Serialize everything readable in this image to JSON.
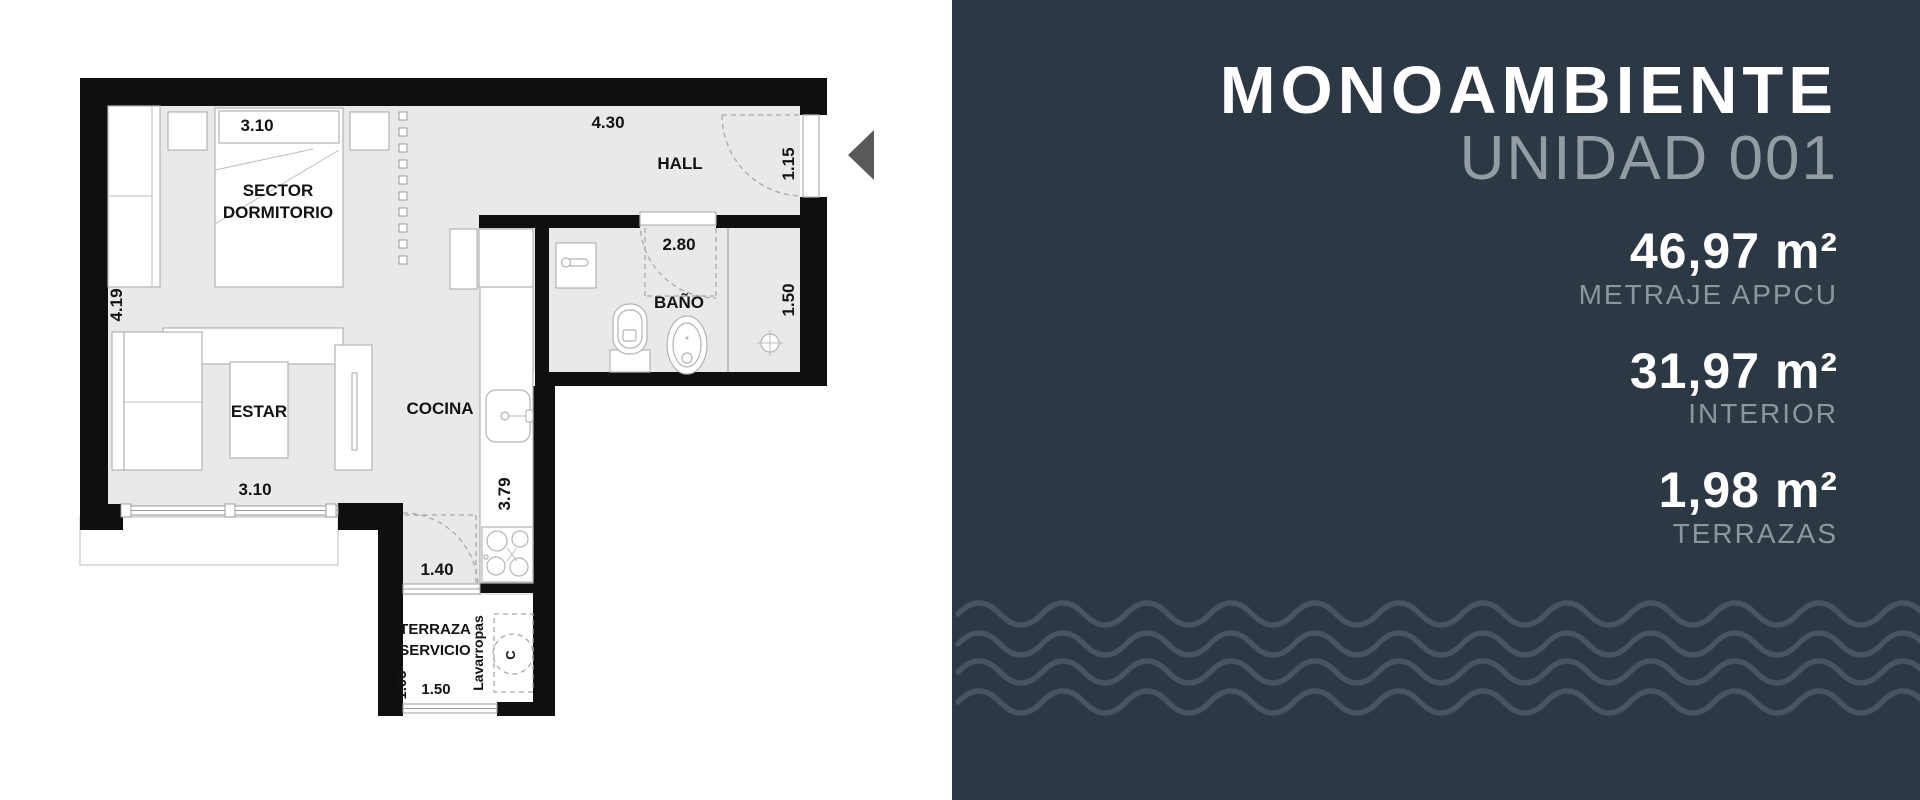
{
  "panel": {
    "title": "MONOAMBIENTE",
    "subtitle": "UNIDAD 001",
    "metrics": [
      {
        "value": "46,97 m²",
        "label": "METRAJE APPCU"
      },
      {
        "value": "31,97 m²",
        "label": "INTERIOR"
      },
      {
        "value": "1,98 m²",
        "label": "TERRAZAS"
      }
    ],
    "colors": {
      "background": "#2c3944",
      "title_text": "#ffffff",
      "muted_text": "#8d969e",
      "wave_line": "#48545f"
    }
  },
  "floorplan": {
    "rooms": {
      "sector_dormitorio_line1": "SECTOR",
      "sector_dormitorio_line2": "DORMITORIO",
      "hall": "HALL",
      "bano": "BAÑO",
      "estar": "ESTAR",
      "cocina": "COCINA",
      "terraza_line1": "TERRAZA",
      "terraza_line2": "SERVICIO",
      "lavarropas": "Lavarropas",
      "closet_c": "C"
    },
    "dimensions": {
      "dorm_width": "3.10",
      "hall_width": "4.30",
      "entry_door": "1.15",
      "left_height": "4.19",
      "bath_width": "2.80",
      "bath_height": "1.50",
      "estar_width": "3.10",
      "kitchen_height": "3.79",
      "service_door": "1.40",
      "terraza_height": "1.05",
      "terraza_width": "1.50"
    }
  }
}
